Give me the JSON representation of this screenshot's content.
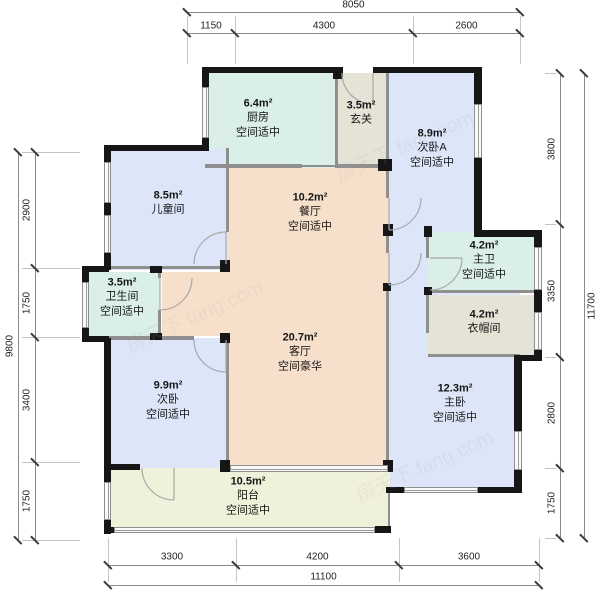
{
  "watermark": "房天下 fang.com",
  "plan": {
    "rooms": [
      {
        "id": "kitchen",
        "area": "6.4m²",
        "name": "厨房",
        "grade": "空间适中",
        "color": "teal",
        "rect": [
          205,
          73,
          130,
          95
        ],
        "label": [
          258,
          118
        ]
      },
      {
        "id": "entry",
        "area": "3.5m²",
        "name": "玄关",
        "grade": "",
        "color": "beige",
        "rect": [
          335,
          73,
          51,
          95
        ],
        "label": [
          361,
          113
        ]
      },
      {
        "id": "bedroom-a",
        "area": "8.9m²",
        "name": "次卧A",
        "grade": "空间适中",
        "color": "blue",
        "rect": [
          386,
          73,
          94,
          157
        ],
        "label": [
          432,
          148
        ]
      },
      {
        "id": "kids-room",
        "area": "8.5m²",
        "name": "儿童间",
        "grade": "",
        "color": "blue",
        "rect": [
          107,
          148,
          121,
          122
        ],
        "label": [
          168,
          203
        ]
      },
      {
        "id": "dining",
        "area": "10.2m²",
        "name": "餐厅",
        "grade": "空间适中",
        "color": "peach",
        "rect": [
          228,
          168,
          162,
          112
        ],
        "label": [
          310,
          212
        ]
      },
      {
        "id": "living",
        "area": "20.7m²",
        "name": "客厅",
        "grade": "空间豪华",
        "color": "peach",
        "rect": [
          228,
          280,
          162,
          187
        ],
        "label": [
          300,
          352
        ]
      },
      {
        "id": "hallway",
        "area": "",
        "name": "",
        "grade": "",
        "color": "peach",
        "rect": [
          162,
          272,
          66,
          64
        ],
        "label": null
      },
      {
        "id": "bathroom",
        "area": "3.5m²",
        "name": "卫生间",
        "grade": "空间适中",
        "color": "teal",
        "rect": [
          85,
          272,
          75,
          66
        ],
        "label": [
          122,
          297
        ]
      },
      {
        "id": "master",
        "area": "12.3m²",
        "name": "主卧",
        "grade": "空间适中",
        "color": "blue",
        "rect": [
          390,
          230,
          130,
          260
        ],
        "label": [
          455,
          403
        ]
      },
      {
        "id": "master-bath",
        "area": "4.2m²",
        "name": "主卫",
        "grade": "空间适中",
        "color": "teal",
        "rect": [
          428,
          232,
          110,
          61
        ],
        "label": [
          484,
          260
        ]
      },
      {
        "id": "cloakroom",
        "area": "4.2m²",
        "name": "衣帽间",
        "grade": "",
        "color": "beige",
        "rect": [
          428,
          295,
          110,
          62
        ],
        "label": [
          484,
          322
        ]
      },
      {
        "id": "bedroom-2",
        "area": "9.9m²",
        "name": "次卧",
        "grade": "空间适中",
        "color": "blue",
        "rect": [
          107,
          338,
          121,
          130
        ],
        "label": [
          168,
          400
        ]
      },
      {
        "id": "balcony",
        "area": "10.5m²",
        "name": "阳台",
        "grade": "空间适中",
        "color": "cream",
        "rect": [
          107,
          468,
          283,
          64
        ],
        "label": [
          248,
          496
        ]
      }
    ]
  },
  "dimensions": {
    "top": {
      "total": "8050",
      "segments": [
        "1150",
        "4300",
        "2600"
      ]
    },
    "bottom": {
      "total": "11100",
      "segments": [
        "3300",
        "4200",
        "3600"
      ]
    },
    "left": {
      "total": "9800",
      "segments": [
        "2900",
        "1750",
        "3400",
        "1750"
      ]
    },
    "right": {
      "total": "11700",
      "segments": [
        "3800",
        "3350",
        "2800",
        "1750"
      ]
    }
  }
}
